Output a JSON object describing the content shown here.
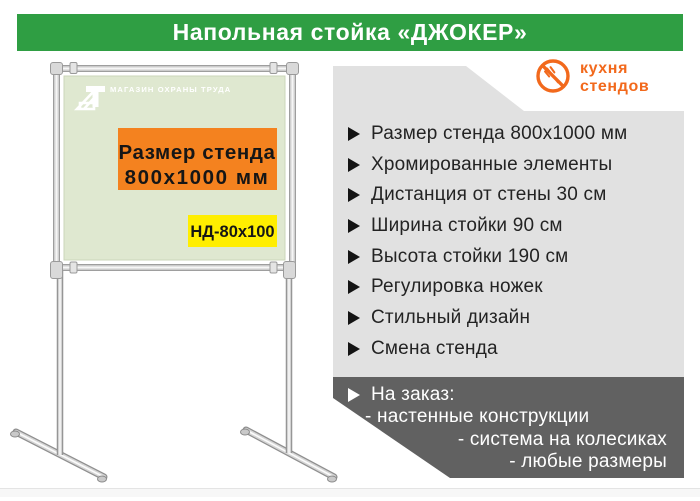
{
  "title": "Напольная стойка «ДЖОКЕР»",
  "brand": {
    "name": "кухня стендов",
    "icon": "no-fork-icon",
    "color": "#f2691c"
  },
  "stand": {
    "watermark": "МАГАЗИН ОХРАНЫ ТРУДА",
    "size_banner": {
      "line1": "Размер стенда",
      "line2": "800х1000 мм"
    },
    "model_tag": "НД-80х100"
  },
  "features": [
    "Размер стенда 800х1000 мм",
    "Хромированные элементы",
    "Дистанция от стены 30 см",
    "Ширина стойки 90 см",
    "Высота стойки 190 см",
    "Регулировка ножек",
    "Стильный дизайн",
    "Смена стенда"
  ],
  "custom_order": {
    "title": "На заказ:",
    "items": [
      "- настенные конструкции",
      "- система на колесиках",
      "- любые размеры"
    ]
  },
  "colors": {
    "banner_green": "#2f9e43",
    "board_bg": "#dfe8d0",
    "highlight_orange": "#f4821f",
    "tag_yellow": "#ffee00",
    "panel_gray": "#e1e1e1",
    "order_dark": "#616161",
    "brand_orange": "#f2691c"
  }
}
